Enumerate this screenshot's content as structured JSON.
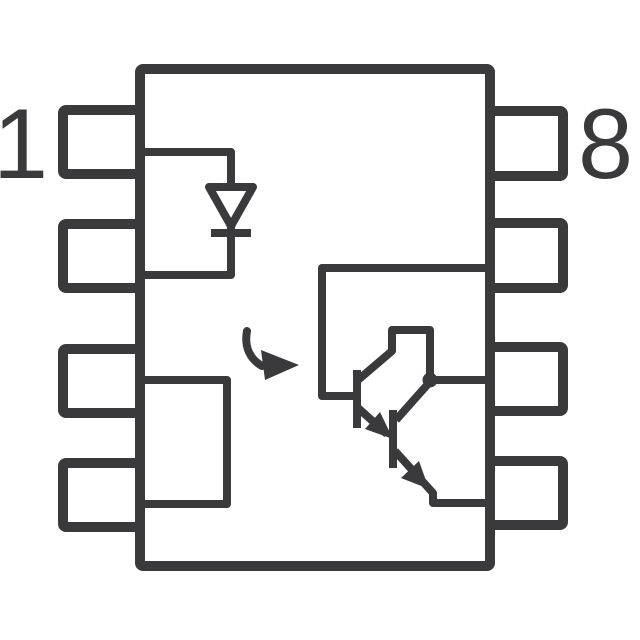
{
  "page": {
    "background_color": "#ffffff",
    "stroke_color": "#3a3a3c"
  },
  "schematic": {
    "kind": "8-pin IC package functional diagram",
    "pin_labels": [
      {
        "position": "left-top",
        "label": "1"
      },
      {
        "position": "right-top",
        "label": "8"
      }
    ],
    "pins": {
      "left_count": 4,
      "right_count": 4
    },
    "icons": [
      "ic-body",
      "pin-pad",
      "led-diode-icon",
      "internal-block",
      "light-arrow-icon",
      "darlington-phototransistor-icon"
    ]
  }
}
